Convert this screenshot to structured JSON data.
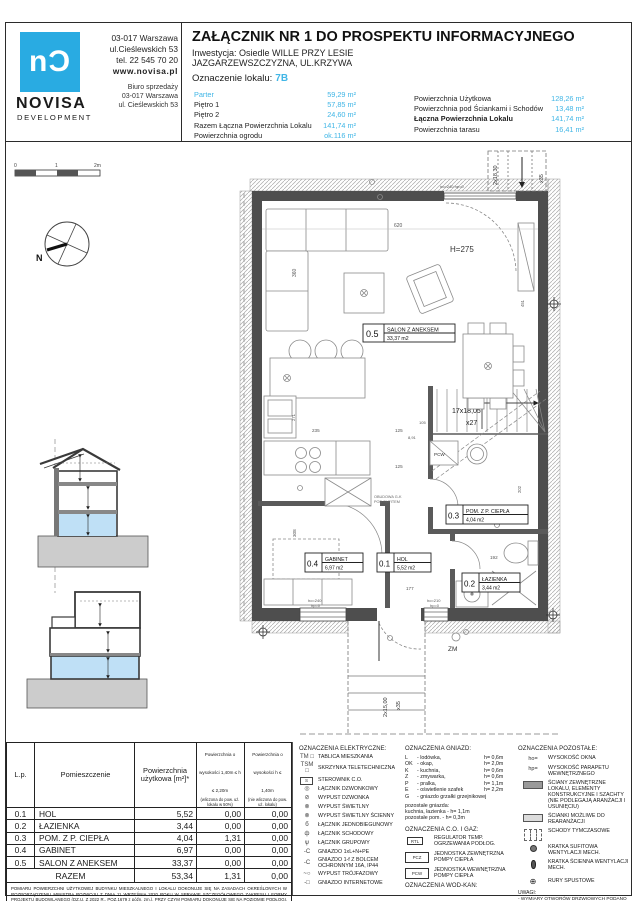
{
  "colors": {
    "accent": "#41b6e6",
    "logo_blue": "#29abe2",
    "wall_dark": "#4e4e4e",
    "floor_highlight": "#bfe0f6",
    "ground_gray": "#cccccc"
  },
  "header": {
    "logo": {
      "mark": "nƆ",
      "name": "NOVISA",
      "sub": "DEVELOPMENT",
      "address1": "03-017 Warszawa",
      "address2": "ul.Cieślewskich 53",
      "phone": "tel.  22 545 70 20",
      "web": "www.novisa.pl",
      "office1": "Biuro sprzedaży",
      "office2": "03-017 Warszawa",
      "office3": "ul. Cieślewskich 53"
    },
    "title": "ZAŁĄCZNIK NR 1 DO PROSPEKTU INFORMACYJNEGO",
    "investment_line1": "Inwestycja: Osiedle WILLE PRZY LESIE",
    "investment_line2": "JAZGARZEWSZCZYZNA, UL.KRZYWA",
    "unit_label": "Oznaczenie lokalu:",
    "unit_value": "7B",
    "areas_left": [
      {
        "label": "Parter",
        "value": "59,29 m²"
      },
      {
        "label": "Piętro 1",
        "value": "57,85 m²"
      },
      {
        "label": "Piętro 2",
        "value": "24,60 m²"
      },
      {
        "label": "Razem Łączna Powierzchnia Lokalu",
        "value": "141,74 m²"
      },
      {
        "label": "Powierzchnia ogrodu",
        "value": "ok.116 m²"
      }
    ],
    "areas_right": [
      {
        "label": "Powierzchnia Użytkowa",
        "value": "128,26 m²"
      },
      {
        "label": "Powierzchnia pod Ściankami i Schodów",
        "value": "13,48 m²"
      },
      {
        "label": "Łączna Powierzchnia Lokalu",
        "value": "141,74 m²"
      },
      {
        "label": "Powierzchnia tarasu",
        "value": "16,41 m²"
      }
    ]
  },
  "plan": {
    "scalebar": {
      "t0": "0",
      "t1": "1",
      "t2": "2m"
    },
    "compass_n": "N",
    "rooms": [
      {
        "num": "0.5",
        "name": "SALON Z ANEKSEM",
        "area": "33,37 m2"
      },
      {
        "num": "0.4",
        "name": "GABINET",
        "area": "6,97 m2"
      },
      {
        "num": "0.1",
        "name": "HOL",
        "area": "5,52 m2"
      },
      {
        "num": "0.3",
        "name": "POM. Z P. CIEPŁA",
        "area": "4,04 m2"
      },
      {
        "num": "0.2",
        "name": "ŁAZIENKA",
        "area": "3,44 m2"
      }
    ],
    "annotations": {
      "height": "H=275",
      "zm": "ZM",
      "pcw": "PCW",
      "obudowa1": "OBUDOWA G-K",
      "obudowa2": "POD SUFITEM"
    },
    "stairs": {
      "main1": "17x18,05",
      "main2": "x27",
      "top1": "2x18,30",
      "top2": "x35",
      "bot1": "2x15,00",
      "bot2": "x35"
    },
    "windows": {
      "w1a": "ho=240",
      "w1b": "hp=0",
      "w2a": "ho=210",
      "w2b": "hp=0",
      "top": "ho=240 hp=0"
    },
    "dims": {
      "d620": "620",
      "d360": "360",
      "d235": "235",
      "d125": "125",
      "d105": "105",
      "d891": "8,91",
      "d308": "308",
      "d177": "177",
      "d192": "192",
      "d271": "271",
      "d202": "202",
      "d451": "451"
    }
  },
  "table": {
    "col1": "L.p.",
    "col2": "Pomieszczenie",
    "col3": "Powierzchnia użytkowa [m²]*",
    "col4": "Powierzchnia o wysokości 1,40m ≤ h ≤ 2,20m",
    "col4sub": "(wliczona do pow. uż. lokalu w 50%)",
    "col5": "Powierzchnia o wysokości h ≤ 1,40m",
    "col5sub": "(nie wliczona do pow. uż. lokalu)",
    "rows": [
      {
        "no": "0.1",
        "name": "HOL",
        "a": "5,52",
        "b": "0,00",
        "c": "0,00"
      },
      {
        "no": "0.2",
        "name": "ŁAZIENKA",
        "a": "3,44",
        "b": "0,00",
        "c": "0,00"
      },
      {
        "no": "0.3",
        "name": "POM. Z P. CIEPŁA",
        "a": "4,04",
        "b": "1,31",
        "c": "0,00"
      },
      {
        "no": "0.4",
        "name": "GABINET",
        "a": "6,97",
        "b": "0,00",
        "c": "0,00"
      },
      {
        "no": "0.5",
        "name": "SALON Z ANEKSEM",
        "a": "33,37",
        "b": "0,00",
        "c": "0,00"
      }
    ],
    "total_label": "RAZEM",
    "total": {
      "a": "53,34",
      "b": "1,31",
      "c": "0,00"
    },
    "footnote": "POMIARU POWIERZCHNI UŻYTKOWEJ BUDYNKU MIESZKALNEGO I LOKALU DOKONUJE SIĘ NA ZASADACH OKREŚLONYCH W ROZPORZĄDZENIU MINISTRA ROZWOJU Z DNIA 11 WRZEŚNIA 2020 ROKU W SPRAWIE SZCZEGÓŁOWEGO ZAKRESU I FORMY PROJEKTU BUDOWLANEGO (DZ.U. Z 2022 R., POZ.1679 z późn. zm.), PRZY CZYM POMIARU DOKONUJE SIĘ NA POZIOMIE PODŁOGI, Z DOKŁADNOŚCIĄ DO 0,01M² (JEDNA SETNA METRA KWADRATOWEGO), W MIESZKANIU W STANIE CAŁKOWICIE WYKOŃCZONYM, A WIĘC Z TYNKAMI. JEDNOCZEŚNIE ŁĄCZNA POWIERZCHNIA LOKALU UWZGLĘDNIA POWIERZCHNIĘ UŻYTKOWĄ ORAZ POWIERZCHNIĘ POD ŚCIANKAMI I SCHODÓW. WYMIARY PODANE NA RYSUNKU ODNOSZĄ SIĘ DO STANU SUROWEGO BUDYNKU (NIE UWZGLĘDNIAJĄ GRUBOŚCI TYNKU)."
  },
  "legend": {
    "electrical": {
      "title": "OZNACZENIA ELEKTRYCZNE:",
      "items": [
        {
          "icon": "TM □",
          "label": "TABLICA MIESZKANIA"
        },
        {
          "icon": "TSM □",
          "label": "SKRZYNKA TELETECHNICZNA"
        },
        {
          "icon": "S",
          "label": "STEROWNIK C.O."
        },
        {
          "icon": "◎",
          "label": "ŁĄCZNIK DZWONKOWY"
        },
        {
          "icon": "⊘",
          "label": "WYPUST DZWONKA"
        },
        {
          "icon": "⊗",
          "label": "WYPUST ŚWIETLNY"
        },
        {
          "icon": "⊗",
          "label": "WYPUST ŚWIETLNY ŚCIENNY"
        },
        {
          "icon": "б",
          "label": "ŁĄCZNIK JEDNOBIEGUNOWY"
        },
        {
          "icon": "ф",
          "label": "ŁĄCZNIK SCHODOWY"
        },
        {
          "icon": "ѱ",
          "label": "ŁĄCZNIK GRUPOWY"
        },
        {
          "icon": "-C",
          "label": "GNIAZDO 1xL+N+PE"
        },
        {
          "icon": "-C",
          "label": "GNIAZDO 1-f Z BOLCEM OCHRONNYM 16A, IP44"
        },
        {
          "icon": "~○",
          "label": "WYPUST TRÓJFAZOWY"
        },
        {
          "icon": "-□",
          "label": "GNIAZDO INTERNETOWE"
        }
      ]
    },
    "sockets": {
      "title": "OZNACZENIA GNIAZD:",
      "items": [
        {
          "code": "L",
          "name": "- lodówka,",
          "h": "h= 0,6m"
        },
        {
          "code": "OK",
          "name": "- okap,",
          "h": "h= 2,0m"
        },
        {
          "code": "K",
          "name": "- kuchnia,",
          "h": "h= 0,6m"
        },
        {
          "code": "Z",
          "name": "- zmywarka,",
          "h": "h= 0,6m"
        },
        {
          "code": "P",
          "name": "- pralka,",
          "h": "h= 1,1m"
        },
        {
          "code": "E",
          "name": "- oświetlenie szafek",
          "h": "h= 2,2m"
        },
        {
          "code": "G",
          "name": "- gniazdo grzałki grzejnikowej",
          "h": ""
        }
      ],
      "notes": [
        "pozostałe gniazda:",
        "kuchnia, łazienka -  h= 1,1m",
        "pozostałe pom. -  h= 0,3m"
      ]
    },
    "co_gas": {
      "title": "OZNACZENIA C.O. I GAZ:",
      "items": [
        {
          "code": "RTL",
          "label": "REGULATOR TEMP. OGRZEWANIA PODŁOG."
        },
        {
          "code": "PCZ",
          "label": "JEDNOSTKA ZEWNĘTRZNA POMPY CIEPŁA"
        },
        {
          "code": "PCW",
          "label": "JEDNOSTKA WEWNĘTRZNA POMPY CIEPŁA"
        }
      ]
    },
    "wod_kan_title": "OZNACZENIA WOD-KAN:",
    "other": {
      "title": "OZNACZENIA POZOSTAŁE:",
      "items": [
        {
          "icon": "ho=",
          "label": "WYSOKOŚĆ OKNA"
        },
        {
          "icon": "hp=",
          "label": "WYSOKOŚĆ PARAPETU WEWNĘTRZNEGO"
        },
        {
          "icon": "",
          "label": "ŚCIANY ZEWNĘTRZNE LOKALU, ELEMENTY KONSTRUKCYJNE I SZACHTY (NIE PODLEGAJĄ ARANŻACJI I USUNIĘCIU)"
        },
        {
          "icon": "",
          "label": "ŚCIANKI MOŻLIWE DO REARANŻACJI"
        },
        {
          "icon": "",
          "label": "SCHODY TYMCZASOWE"
        },
        {
          "icon": "",
          "label": "KRATKA SUFITOWA WENTYLACJI MECH."
        },
        {
          "icon": "",
          "label": "KRATKA ŚCIENNA WENTYLACJI MECH."
        },
        {
          "icon": "⊕",
          "label": "RURY SPUSTOWE"
        }
      ],
      "uwagi_title": "UWAGI:",
      "uwagi": [
        "- WYMIARY OTWORÓW DRZWIOWYCH PODANO W ŚWIETLE OŚCIEŻY.",
        "- PODANE WYMIARY DOTYCZĄ STANU SUROWEGO I MAJĄ CHARAKTER POGLĄDOWY."
      ]
    }
  }
}
